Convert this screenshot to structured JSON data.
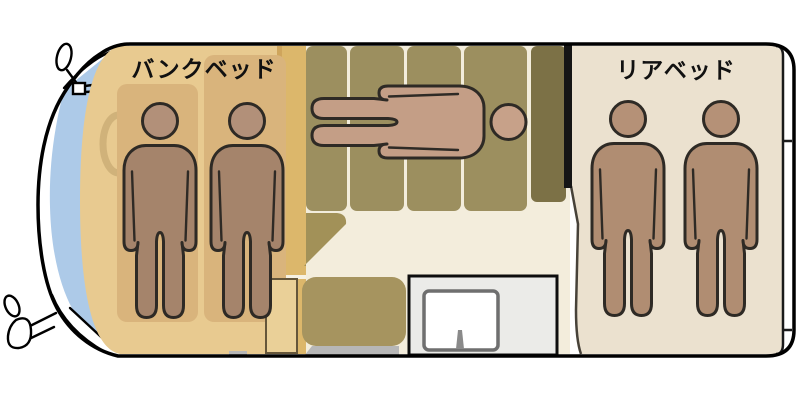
{
  "labels": {
    "bunk_bed": "バンクベッド",
    "rear_bed": "リアベッド"
  },
  "sleeping_capacity": {
    "bunk_bed": 2,
    "sofa_bed": 1,
    "rear_bed": 2,
    "total": 5
  },
  "colors": {
    "outline": "#000000",
    "figure-outline": "#2e2a25",
    "bunk-area": "#e8ca90",
    "bunk-mattress": "#d9b47c",
    "gold-strip": "#dcb76b",
    "gold-strip-edge": "#cfa55c",
    "sofa-cushion": "#9c8f5f",
    "sofa-cushion-dark": "#7c7146",
    "seat-khaki": "#a29158",
    "table": "#a6945f",
    "cabinet": "#ead098",
    "cabinet-border": "#65563a",
    "floor": "#f3eddc",
    "counter": "#ebebe8",
    "sink-border": "#6f6f6f",
    "faucet": "#8a8a8a",
    "step": "#b7b7b7",
    "rear-bed": "#ebe1cf",
    "windshield": "#adcae8",
    "steering": "#bc9f67",
    "skin-bunk": "#a5846b",
    "skin-bunk-head": "#b29079",
    "skin-lying": "#c49e86",
    "skin-lying-head": "#c7a189",
    "skin-rear": "#b08d72",
    "skin-rear-head": "#b59177",
    "label-text": "#111111"
  }
}
